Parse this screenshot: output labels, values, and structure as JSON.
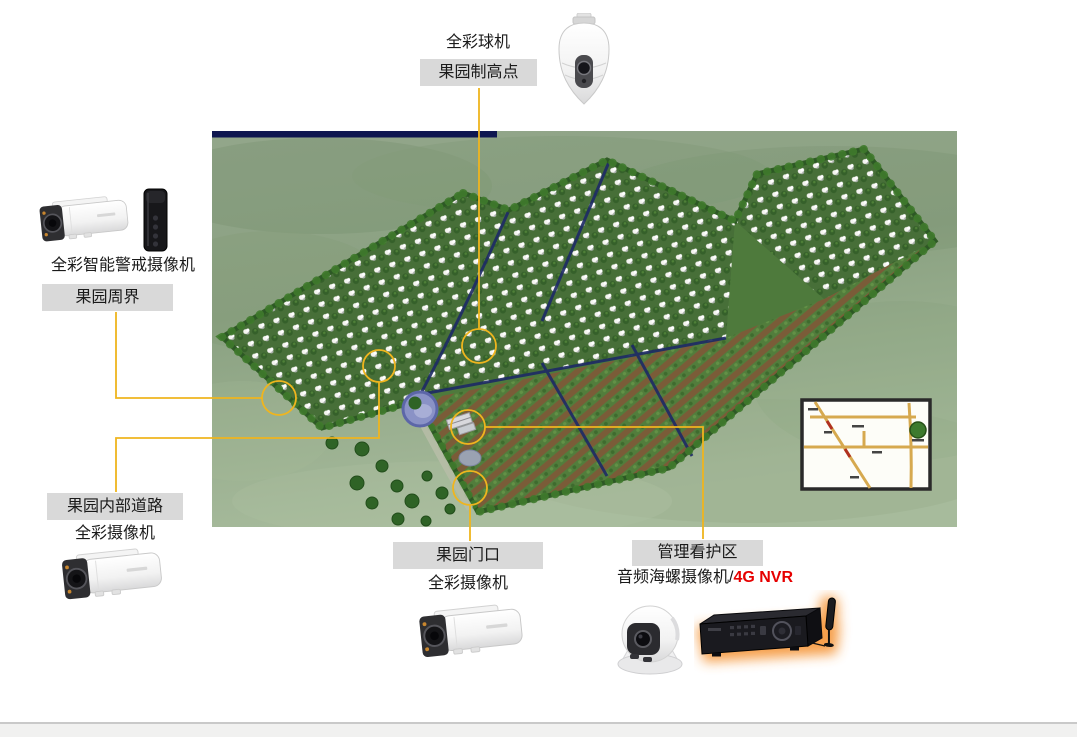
{
  "colors": {
    "connector": "#EFB51E",
    "label_box": "#D9D9D9",
    "text": "#1A1A1A",
    "accent_red": "#E60000",
    "footer_bg": "#F1F1F0",
    "footer_border": "#C9C9C9",
    "nvr_glow": "#F59537",
    "water_channel": "#1D2A66"
  },
  "callouts": {
    "highpoint": {
      "device": "全彩球机",
      "location": "果园制高点",
      "icon": "ptz-dome-camera"
    },
    "perimeter": {
      "device": "全彩智能警戒摄像机",
      "location": "果园周界",
      "icons": [
        "bullet-camera",
        "alarm-strobe"
      ]
    },
    "road": {
      "location": "果园内部道路",
      "device": "全彩摄像机",
      "icon": "bullet-camera"
    },
    "gate": {
      "location": "果园门口",
      "device": "全彩摄像机",
      "icon": "bullet-camera"
    },
    "management": {
      "location": "管理看护区",
      "device_prefix": "音频海螺摄像机/",
      "device_suffix": "4G NVR",
      "icons": [
        "turret-camera",
        "4g-nvr-with-antenna"
      ]
    }
  },
  "scene": {
    "description": "orchard aerial plan rendering with camera position markers and inset site map",
    "markers": [
      {
        "name": "highpoint",
        "x": 479,
        "y": 346,
        "r": 17
      },
      {
        "name": "perimeter",
        "x": 279,
        "y": 398,
        "r": 17
      },
      {
        "name": "road",
        "x": 379,
        "y": 366,
        "r": 16
      },
      {
        "name": "management",
        "x": 468,
        "y": 427,
        "r": 17
      },
      {
        "name": "gate",
        "x": 470,
        "y": 488,
        "r": 17
      }
    ],
    "connectors": [
      {
        "name": "highpoint",
        "points": [
          [
            479,
            88
          ],
          [
            479,
            329
          ]
        ]
      },
      {
        "name": "perimeter",
        "points": [
          [
            116,
            312
          ],
          [
            116,
            398
          ],
          [
            262,
            398
          ]
        ]
      },
      {
        "name": "road",
        "points": [
          [
            379,
            382
          ],
          [
            379,
            438
          ],
          [
            116,
            438
          ],
          [
            116,
            492
          ]
        ]
      },
      {
        "name": "management",
        "points": [
          [
            485,
            427
          ],
          [
            703,
            427
          ],
          [
            703,
            539
          ]
        ]
      },
      {
        "name": "gate",
        "points": [
          [
            470,
            505
          ],
          [
            470,
            541
          ]
        ]
      }
    ]
  }
}
